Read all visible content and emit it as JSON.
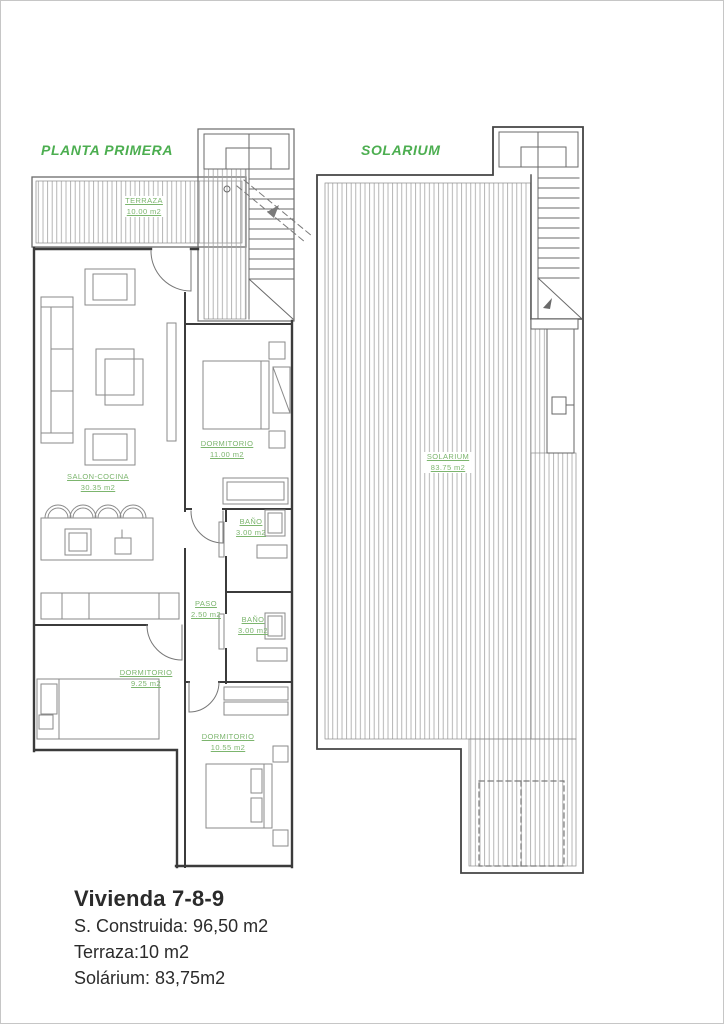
{
  "colors": {
    "title_green": "#4cae50",
    "label_green": "#7cb56e",
    "wall_gray": "#3b3b3b",
    "furniture_gray": "#8a8a8a",
    "hatch_gray": "#a3a3a3",
    "footer_text": "#2b2b2b"
  },
  "plans": {
    "planta_primera": {
      "title": "PLANTA PRIMERA",
      "rooms": [
        {
          "name": "TERRAZA",
          "area": "10.00 m2"
        },
        {
          "name": "DORMITORIO",
          "area": "11.00 m2"
        },
        {
          "name": "SALON-COCINA",
          "area": "30.35 m2"
        },
        {
          "name": "BAÑO",
          "area": "3.00 m2"
        },
        {
          "name": "PASO",
          "area": "2.50 m2"
        },
        {
          "name": "BAÑO",
          "area": "3.00 m2"
        },
        {
          "name": "DORMITORIO",
          "area": "9.25 m2"
        },
        {
          "name": "DORMITORIO",
          "area": "10.55 m2"
        }
      ]
    },
    "solarium": {
      "title": "SOLARIUM",
      "rooms": [
        {
          "name": "SOLARIUM",
          "area": "83.75 m2"
        }
      ]
    }
  },
  "footer": {
    "title": "Vivienda 7-8-9",
    "lines": [
      "S. Construida: 96,50 m2",
      "Terraza:10 m2",
      "Solárium: 83,75m2"
    ]
  }
}
